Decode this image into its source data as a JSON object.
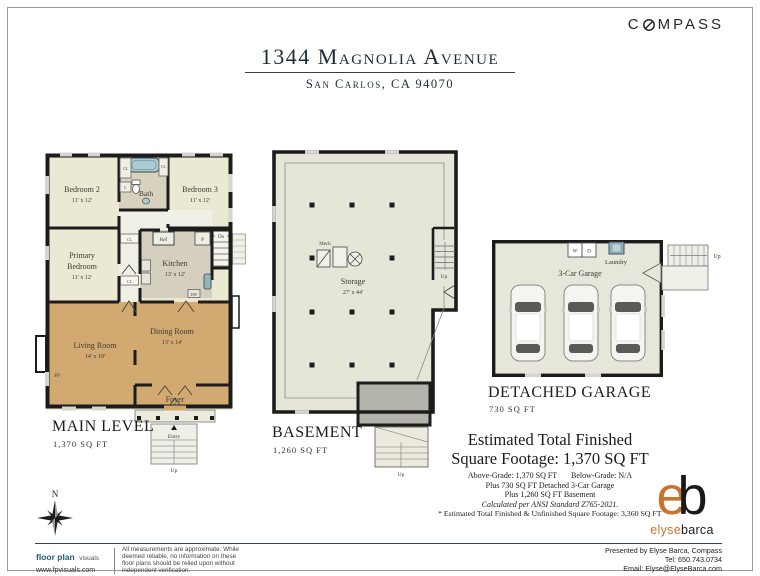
{
  "brand": {
    "compass_prefix": "C",
    "compass_suffix": "MPASS"
  },
  "header": {
    "title": "1344 Magnolia Avenue",
    "subtitle": "San Carlos, CA 94070"
  },
  "main_level": {
    "label": "MAIN LEVEL",
    "sqft": "1,370 SQ FT",
    "rooms": {
      "bedroom2": {
        "name": "Bedroom 2",
        "dims": "11' x 12'"
      },
      "bedroom3": {
        "name": "Bedroom 3",
        "dims": "11' x 12'"
      },
      "bath": {
        "name": "Bath"
      },
      "primary": {
        "line1": "Primary",
        "line2": "Bedroom",
        "dims": "11' x 12'"
      },
      "kitchen": {
        "name": "Kitchen",
        "dims": "13' x 12'"
      },
      "living": {
        "name": "Living Room",
        "dims": "14' x 19'"
      },
      "dining": {
        "name": "Dining Room",
        "dims": "13' x 14'"
      },
      "foyer": {
        "name": "Foyer"
      }
    },
    "ann": {
      "ref": "Ref",
      "p": "P",
      "dn": "Dn",
      "cl": "CL",
      "l": "L",
      "dw": "DW",
      "fp": "FP",
      "entry": "Entry",
      "up": "Up"
    }
  },
  "basement": {
    "label": "BASEMENT",
    "sqft": "1,260 SQ FT",
    "rooms": {
      "storage": {
        "name": "Storage",
        "dims": "27' x 44'"
      }
    },
    "ann": {
      "mech": "Mech",
      "up_stairs": "Up",
      "up_entry": "Up"
    }
  },
  "garage": {
    "label": "DETACHED GARAGE",
    "sqft": "730 SQ FT",
    "rooms": {
      "name": "3-Car Garage",
      "laundry": "Laundry"
    },
    "ann": {
      "w": "W",
      "d": "D",
      "up": "Up"
    }
  },
  "summary": {
    "line1": "Estimated Total Finished",
    "line2": "Square Footage: 1,370 SQ FT",
    "above_grade": "Above-Grade: 1,370 SQ FT",
    "below_grade": "Below-Grade: N/A",
    "line4": "Plus 730 SQ FT Detached 3-Car Garage",
    "line5": "Plus 1,260 SQ FT Basement",
    "line6": "Calculated per ANSI Standard Z765-2021.",
    "footnote": "* Estimated Total Finished & Unfinished Square Footage: 3,360 SQ FT"
  },
  "agent": {
    "logo_e": "e",
    "logo_b": "b",
    "name_first": "elyse",
    "name_last": "barca",
    "presented_by": "Presented by Elyse Barca, Compass",
    "tel": "Tel: 650.743.0734",
    "email": "Email: Elyse@ElyseBarca.com"
  },
  "fpv": {
    "brand_bold": "floor plan",
    "brand_light": "visuals",
    "url": "www.fpvisuals.com",
    "phone": "415.670.9265",
    "disclaimer": "All measurements are approximate. While deemed reliable, no information on these floor plans should be relied upon without independent verification."
  },
  "compass_rose": {
    "label": "N"
  },
  "colors": {
    "wood": "#d2a971",
    "cream": "#ebe9d3",
    "tan": "#d8d1bd",
    "kitchen": "#d5cfbf",
    "basement_fill": "#e6e6d8",
    "vestibule_gray": "#b3b3ab",
    "wall": "#1c1c1c",
    "teal": "#20616e",
    "orange": "#c9732c",
    "navy": "#1d2b36",
    "tub_blue": "#a9cdd2"
  }
}
